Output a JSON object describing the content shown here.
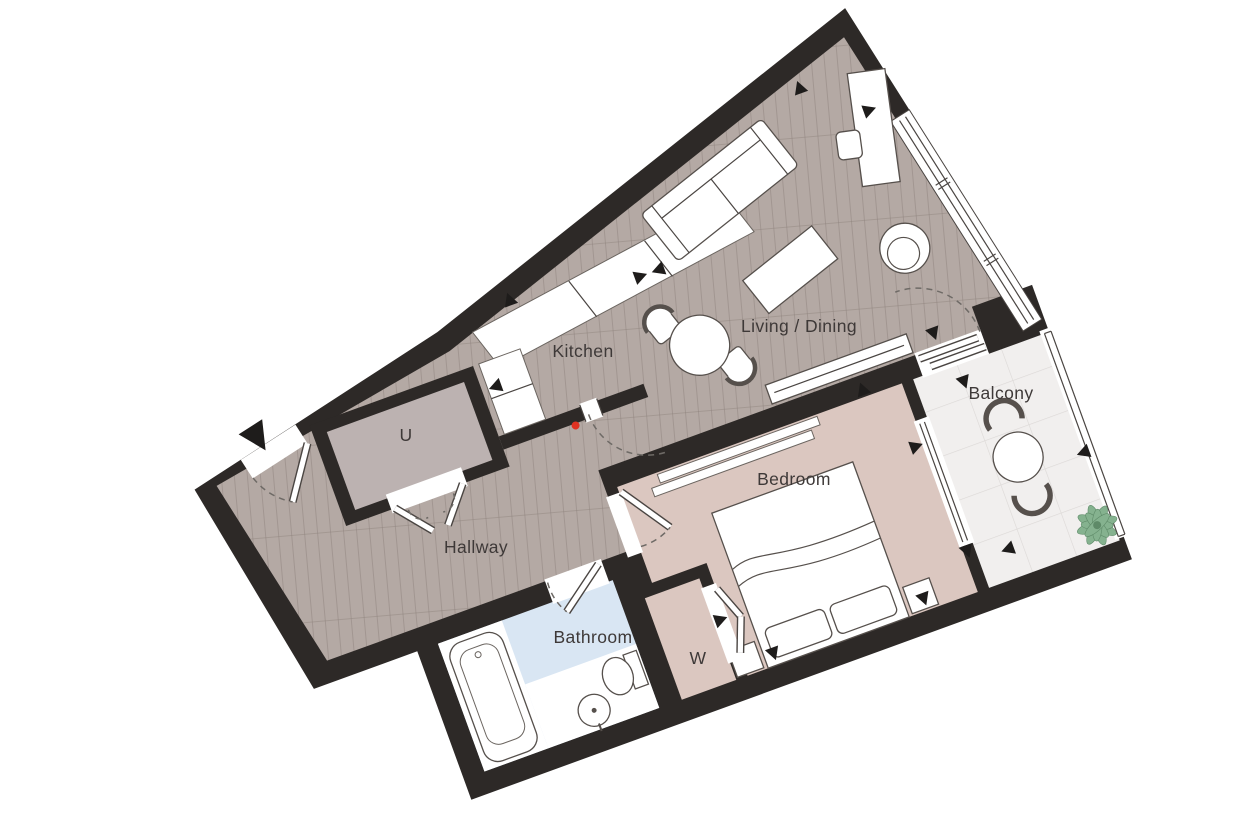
{
  "floorplan": {
    "type": "apartment-floor-plan",
    "rooms": {
      "kitchen": {
        "label": "Kitchen"
      },
      "living_dining": {
        "label": "Living / Dining"
      },
      "balcony": {
        "label": "Balcony"
      },
      "bedroom": {
        "label": "Bedroom"
      },
      "bathroom": {
        "label": "Bathroom"
      },
      "hallway": {
        "label": "Hallway"
      },
      "utility": {
        "label": "U"
      },
      "wardrobe": {
        "label": "W"
      }
    },
    "colors": {
      "wall": "#2d2927",
      "wood_floor": "#b4a9a4",
      "wood_floor_line": "#8f837d",
      "utility_floor": "#bcb2b1",
      "bedroom_floor": "#dbc7c0",
      "bathroom_floor": "#d9e6f3",
      "balcony_floor": "#f1efee",
      "balcony_tile_line": "#dcd8d6",
      "plant": "#85b28f",
      "marker_dot": "#e03222",
      "label_text": "#3e3938"
    },
    "furniture": [
      "sofa",
      "coffee-table",
      "round-dining-table",
      "dining-chairs",
      "desk",
      "desk-chair",
      "armchair",
      "kitchen-counter",
      "double-bed",
      "pillows",
      "nightstands",
      "wardrobe-unit",
      "sideboard",
      "bathtub",
      "toilet",
      "wash-basin",
      "balcony-table",
      "balcony-chairs",
      "plant"
    ],
    "markers": {
      "entrance_arrow": true,
      "dimension_triangles": 17,
      "red_dot": true,
      "door_swing_arcs": 6
    }
  }
}
